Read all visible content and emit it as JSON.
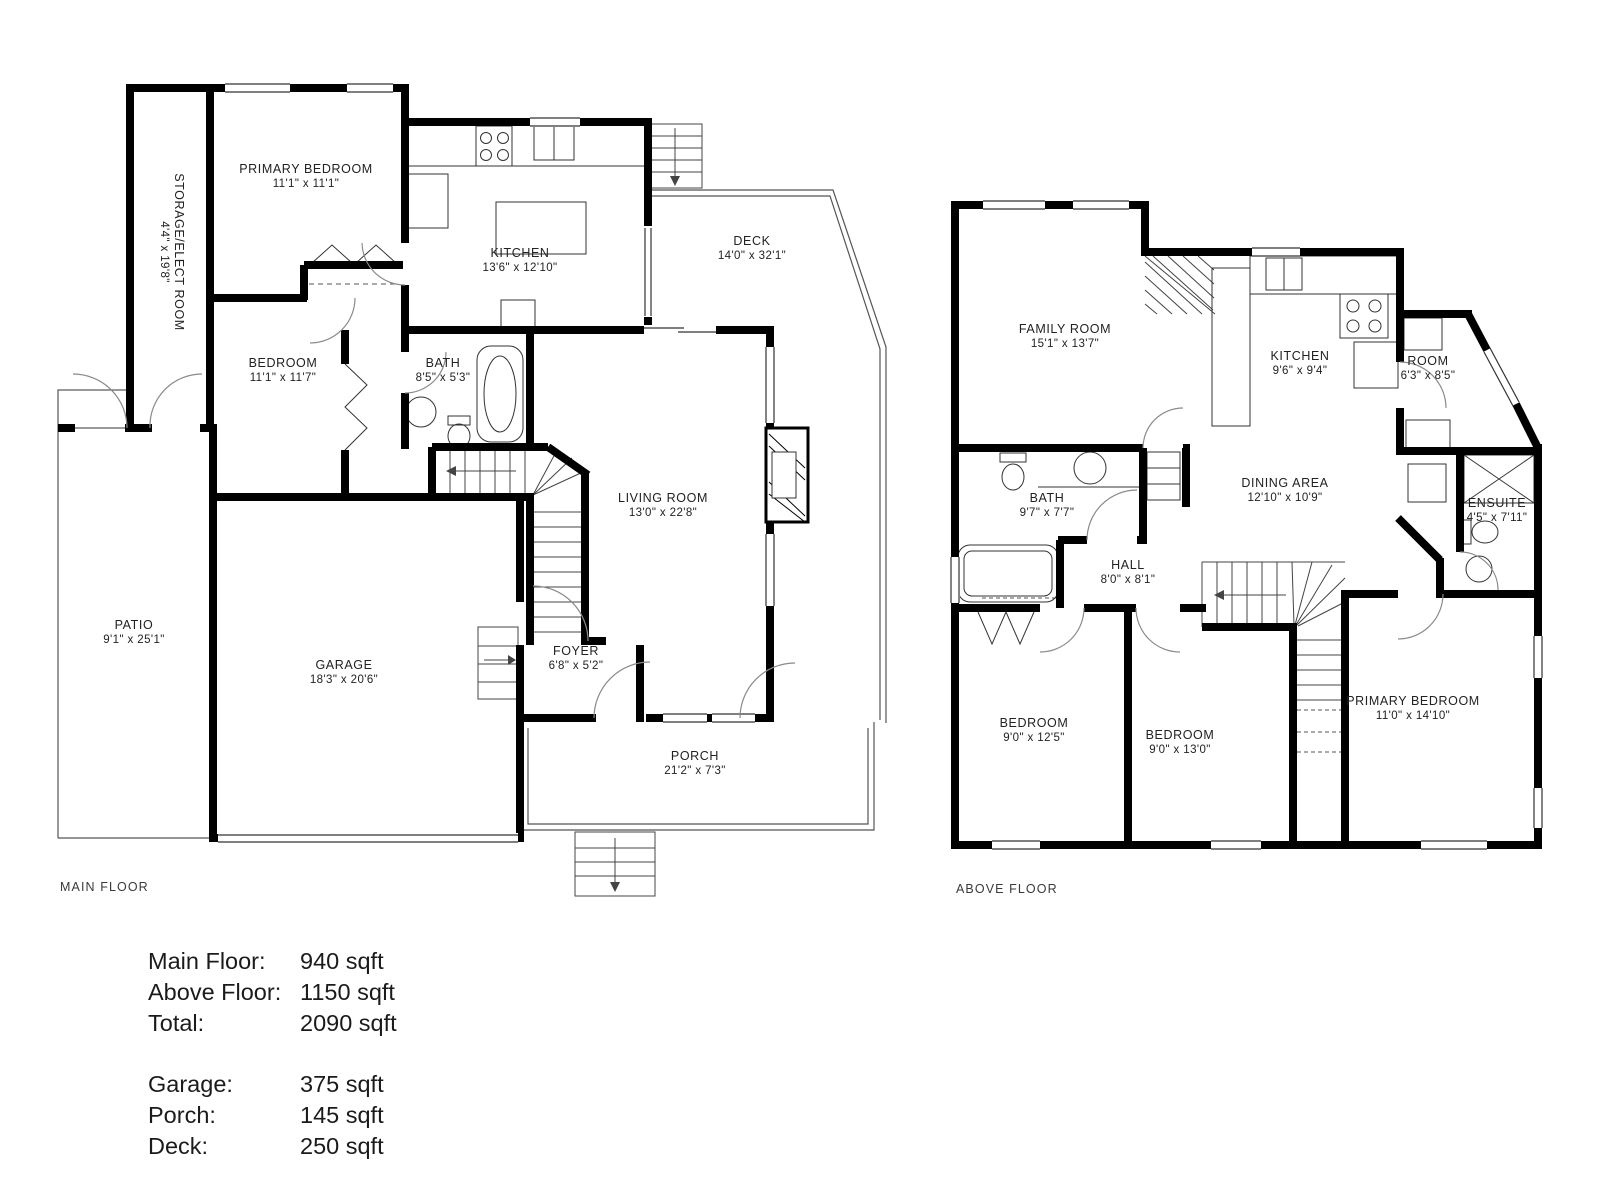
{
  "colors": {
    "wall": "#000000",
    "thin": "#2e2e2e",
    "door": "#8a8a8a",
    "text": "#222222"
  },
  "floors": {
    "main": {
      "title": "MAIN FLOOR",
      "rooms": {
        "storage": {
          "name": "STORAGE/ELECT ROOM",
          "dims": "4'4\" x 19'8\""
        },
        "primary": {
          "name": "PRIMARY BEDROOM",
          "dims": "11'1\" x 11'1\""
        },
        "kitchen": {
          "name": "KITCHEN",
          "dims": "13'6\" x 12'10\""
        },
        "deck": {
          "name": "DECK",
          "dims": "14'0\" x 32'1\""
        },
        "bedroom": {
          "name": "BEDROOM",
          "dims": "11'1\" x 11'7\""
        },
        "bath": {
          "name": "BATH",
          "dims": "8'5\" x 5'3\""
        },
        "living": {
          "name": "LIVING ROOM",
          "dims": "13'0\" x 22'8\""
        },
        "patio": {
          "name": "PATIO",
          "dims": "9'1\" x 25'1\""
        },
        "garage": {
          "name": "GARAGE",
          "dims": "18'3\" x 20'6\""
        },
        "foyer": {
          "name": "FOYER",
          "dims": "6'8\" x 5'2\""
        },
        "porch": {
          "name": "PORCH",
          "dims": "21'2\" x 7'3\""
        }
      }
    },
    "above": {
      "title": "ABOVE FLOOR",
      "rooms": {
        "family": {
          "name": "FAMILY ROOM",
          "dims": "15'1\" x 13'7\""
        },
        "kitchen": {
          "name": "KITCHEN",
          "dims": "9'6\" x 9'4\""
        },
        "room": {
          "name": "ROOM",
          "dims": "6'3\" x 8'5\""
        },
        "bath": {
          "name": "BATH",
          "dims": "9'7\" x 7'7\""
        },
        "dining": {
          "name": "DINING AREA",
          "dims": "12'10\" x 10'9\""
        },
        "ensuite": {
          "name": "ENSUITE",
          "dims": "4'5\" x 7'11\""
        },
        "hall": {
          "name": "HALL",
          "dims": "8'0\" x 8'1\""
        },
        "bedroom1": {
          "name": "BEDROOM",
          "dims": "9'0\" x 12'5\""
        },
        "bedroom2": {
          "name": "BEDROOM",
          "dims": "9'0\" x 13'0\""
        },
        "primary": {
          "name": "PRIMARY BEDROOM",
          "dims": "11'0\" x 14'10\""
        }
      }
    }
  },
  "summary": {
    "rows": [
      {
        "label": "Main Floor:",
        "value": "940 sqft"
      },
      {
        "label": "Above Floor:",
        "value": "1150 sqft"
      },
      {
        "label": "Total:",
        "value": "2090 sqft"
      },
      {
        "label": "Garage:",
        "value": "375 sqft"
      },
      {
        "label": "Porch:",
        "value": "145 sqft"
      },
      {
        "label": "Deck:",
        "value": "250 sqft"
      }
    ]
  }
}
